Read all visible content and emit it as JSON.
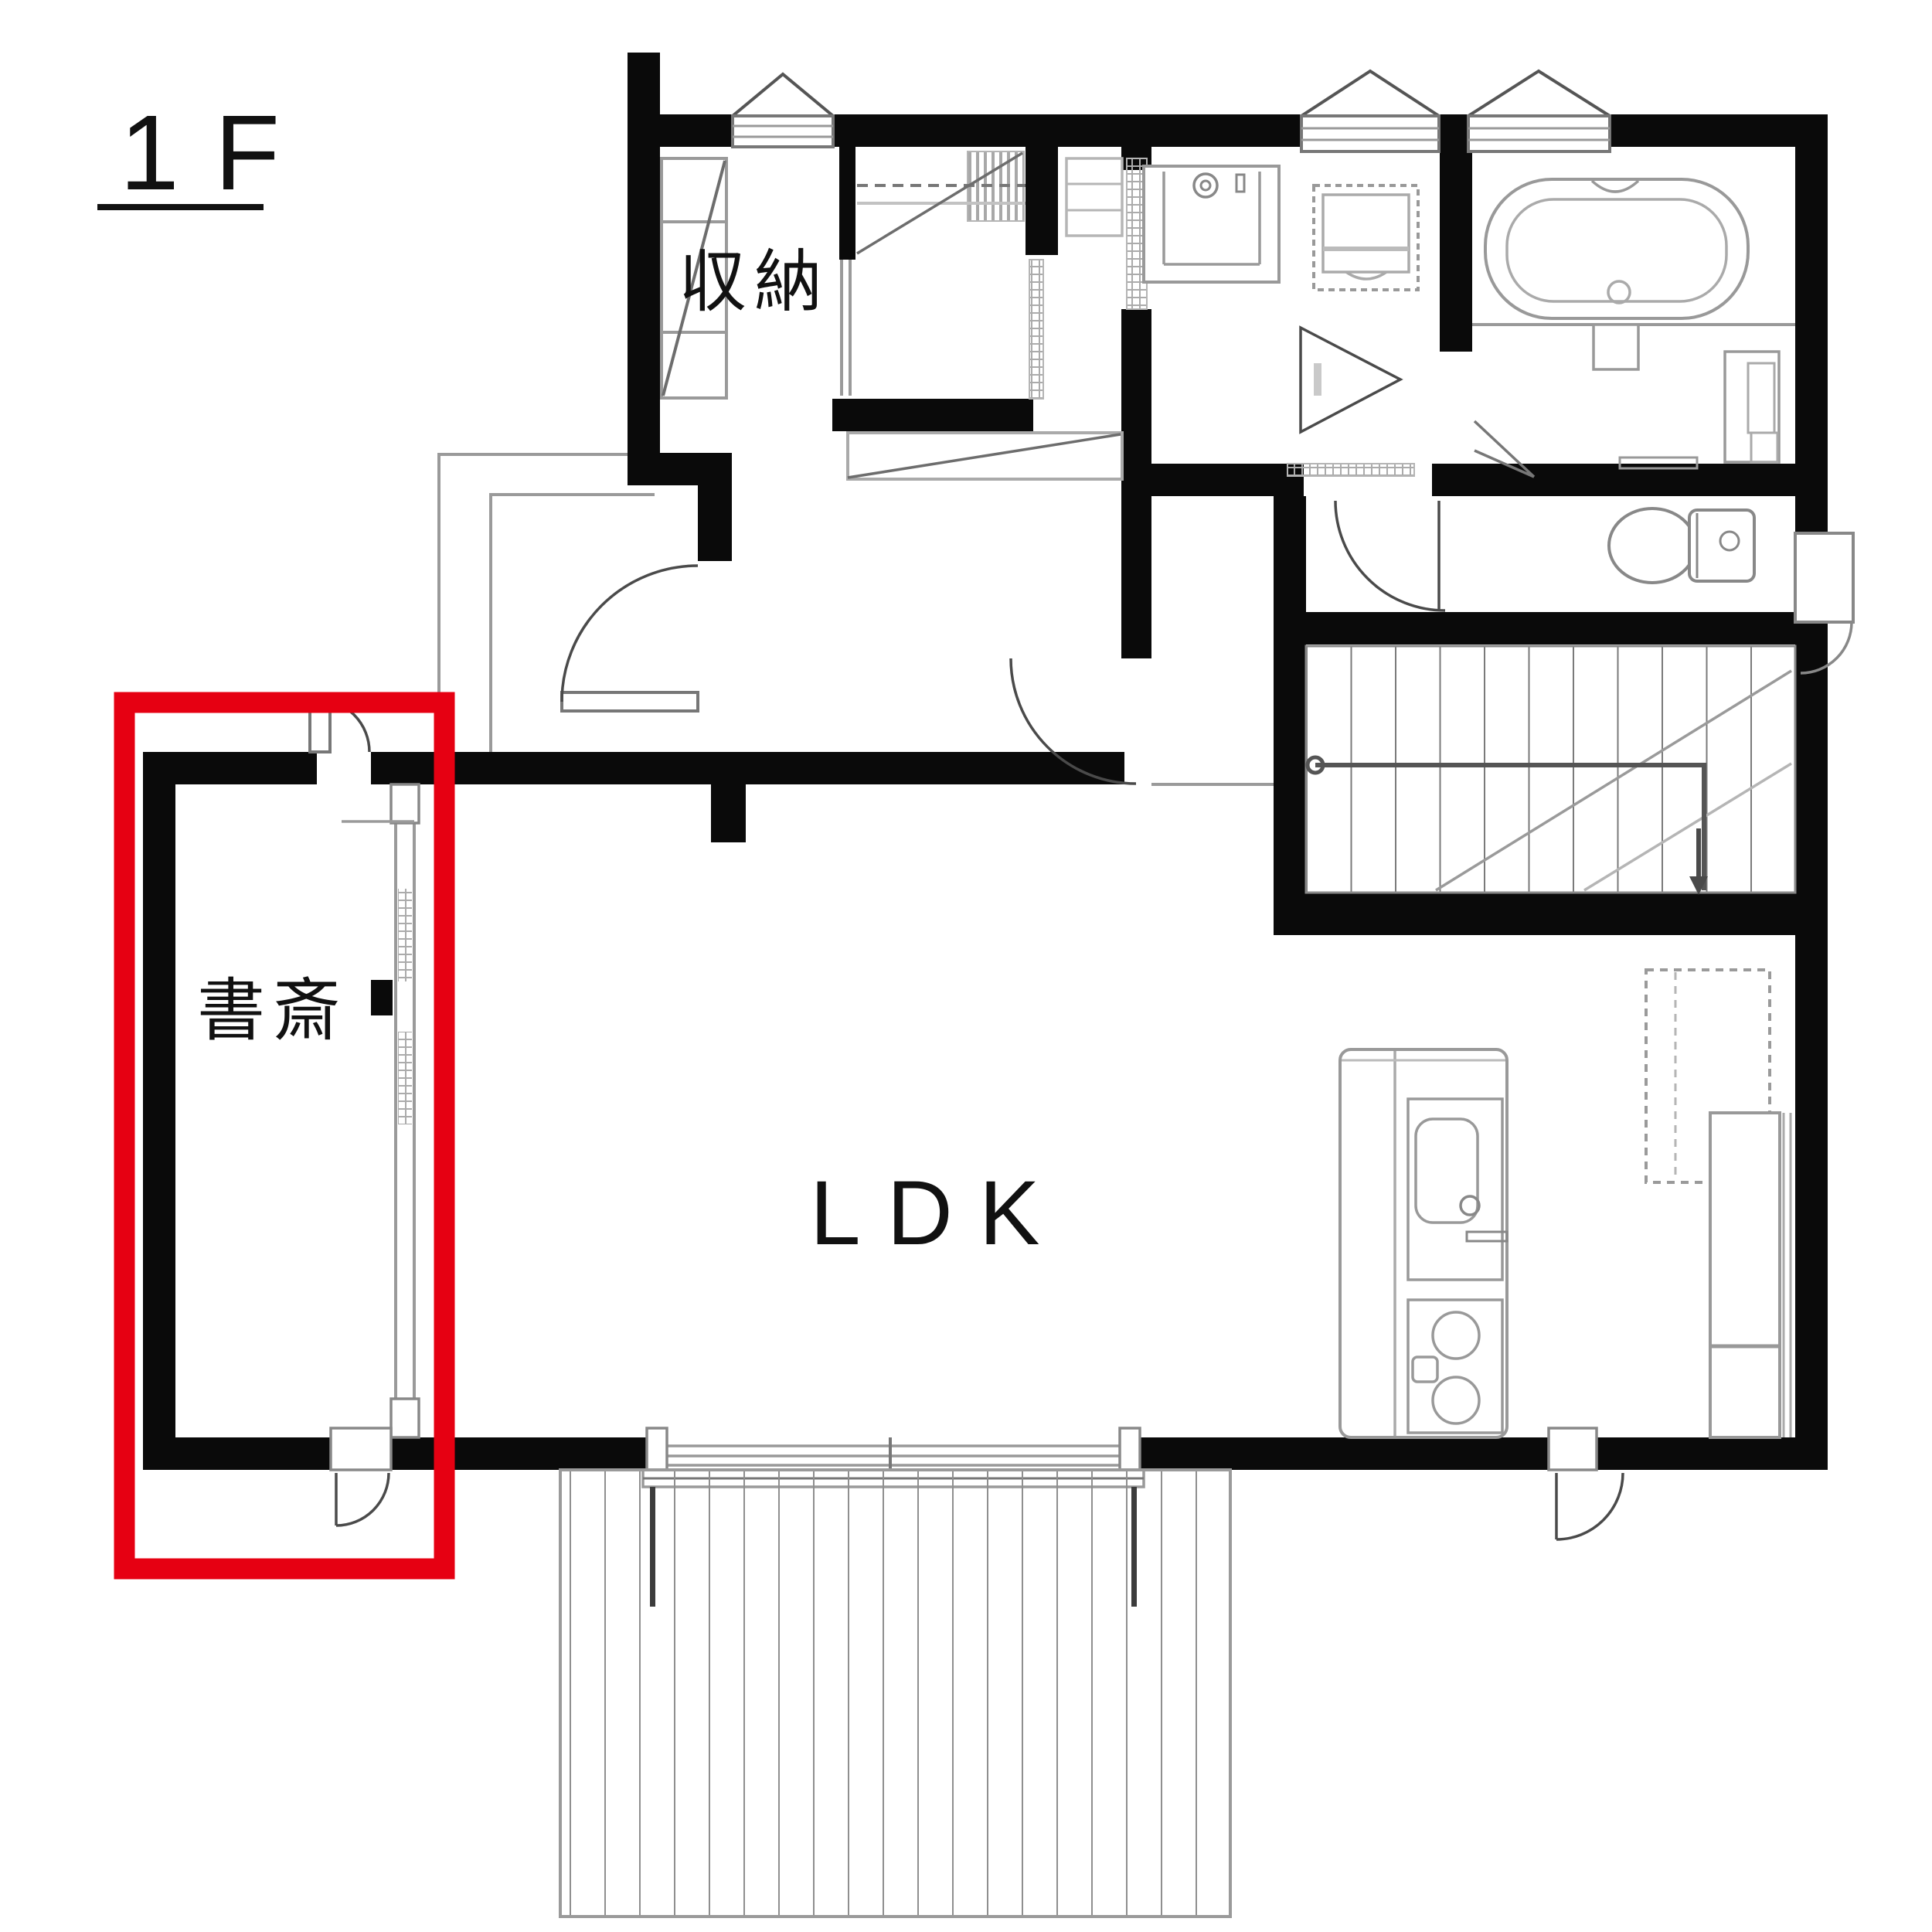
{
  "floor": {
    "label": "1F"
  },
  "rooms": {
    "storage": {
      "label": "収納"
    },
    "study": {
      "label": "書斎"
    },
    "ldk": {
      "label": "LDK"
    }
  },
  "highlight": {
    "highlighted_room_label": "書斎",
    "shape": "rectangle",
    "color": "#e60012"
  },
  "colors": {
    "background": "#ffffff",
    "wall": "#0a0a0a",
    "line": "#909090",
    "light_line": "#bdbdbd",
    "dark_line": "#4a4a4a",
    "text": "#111111"
  }
}
